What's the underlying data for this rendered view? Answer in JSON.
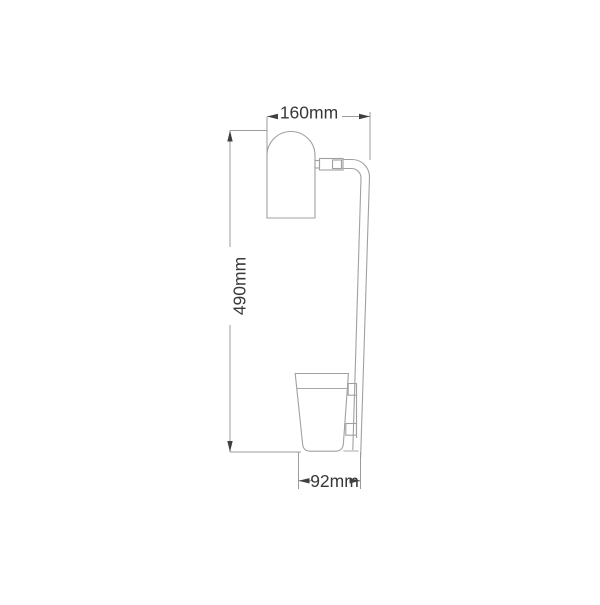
{
  "diagram": {
    "dimensions": {
      "top_width": "160mm",
      "height": "490mm",
      "bottom_width": "92mm"
    },
    "parts": {
      "lamp_head": "dome-top cylindrical lamp head",
      "swivel_joint": "adjustable swivel joint",
      "arm": "curved vertical arm",
      "cup": "tapered cup shade",
      "bracket": "wall mount bracket"
    },
    "colors": {
      "background": "#ffffff",
      "outline": "#a0a0a0",
      "dimension_line": "#9b9b9b",
      "arrow": "#3f3f3f",
      "text": "#383838"
    }
  }
}
